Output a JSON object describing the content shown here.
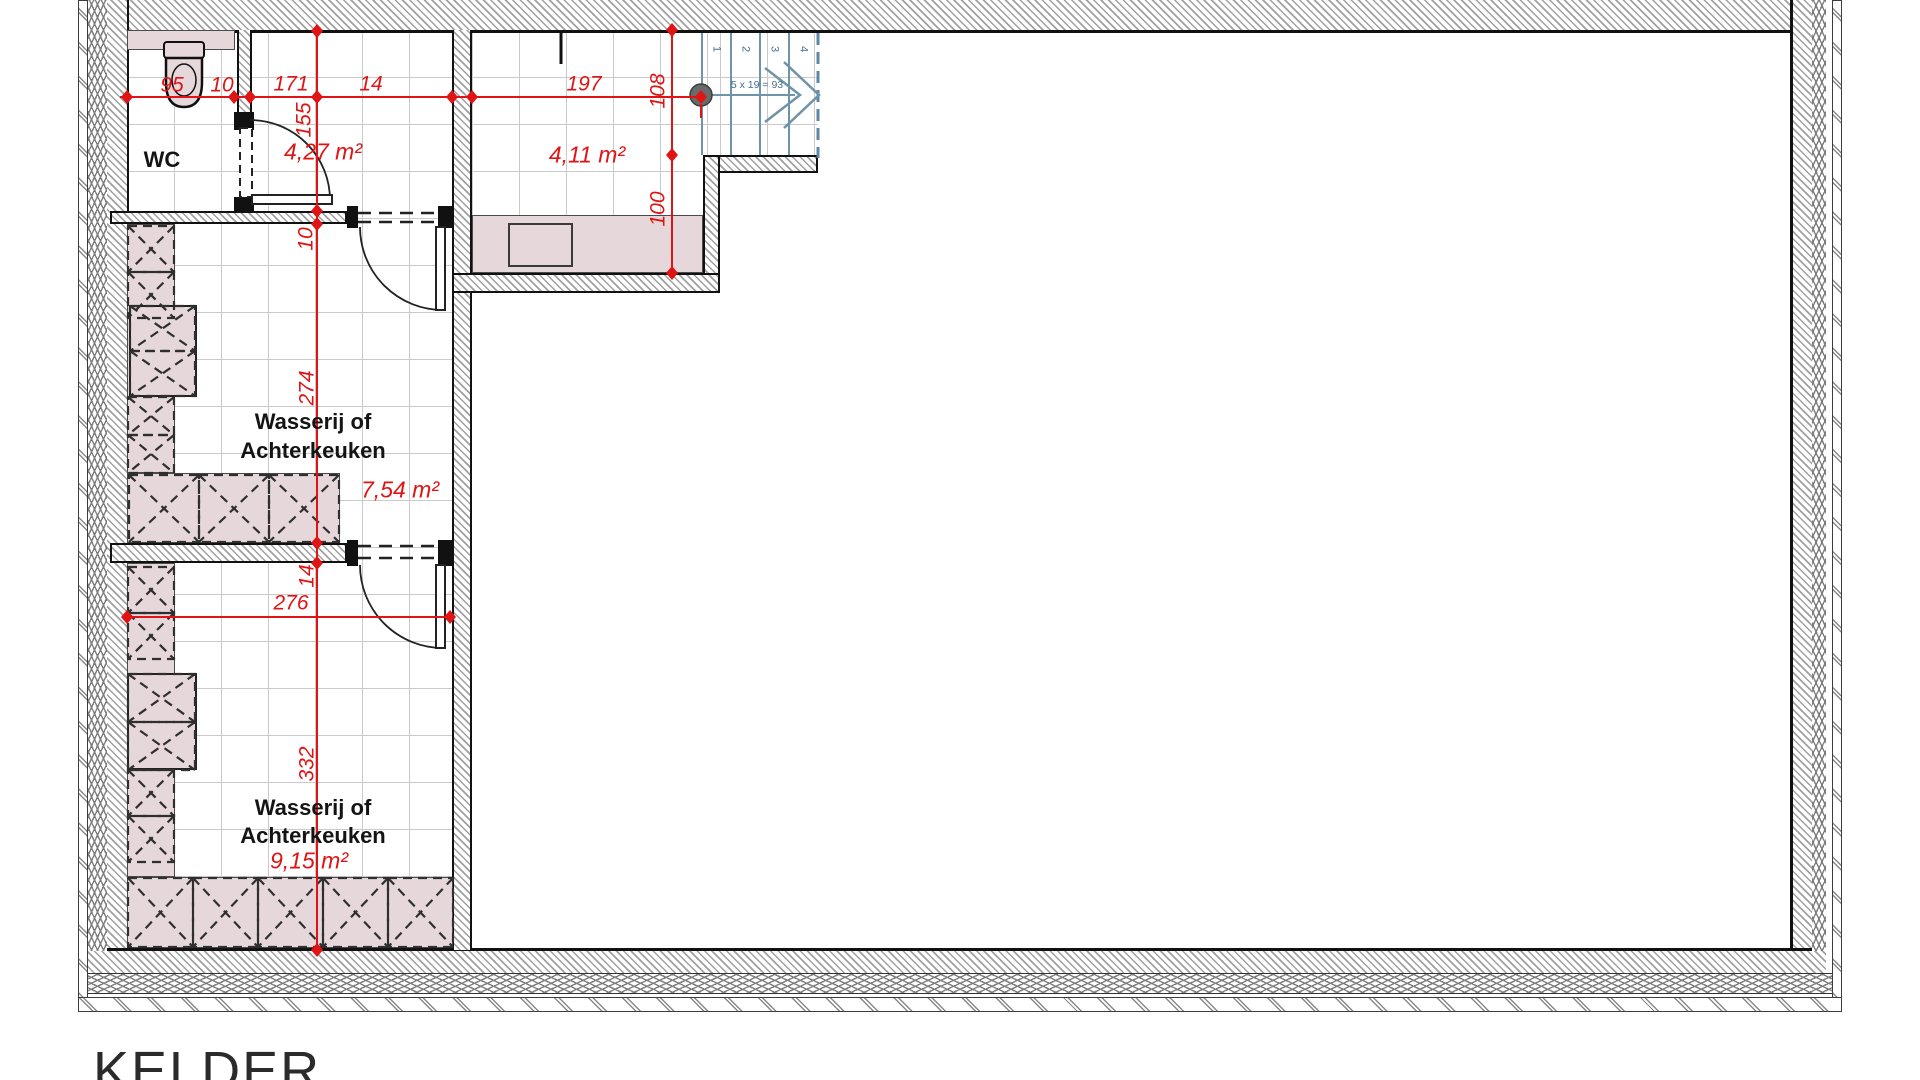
{
  "title": "KELDER",
  "rooms": {
    "wc": {
      "label": "WC"
    },
    "hall": {
      "area": "4,27 m²"
    },
    "stair_landing": {
      "area": "4,11 m²"
    },
    "laundry_upper": {
      "line1": "Wasserij of",
      "line2": "Achterkeuken",
      "area": "7,54 m²"
    },
    "laundry_lower": {
      "line1": "Wasserij of",
      "line2": "Achterkeuken",
      "area": "9,15 m²"
    }
  },
  "dimensions": {
    "wc_width": "95",
    "wc_wall_thickness": "10",
    "hall_width": "171",
    "wall_b_thickness": "14",
    "landing_width": "197",
    "hall_depth": "155",
    "wall_c_thickness": "10",
    "laundry_upper_depth": "274",
    "wall_d_thickness": "14",
    "laundry_lower_depth": "332",
    "stair_upper_run": "108",
    "stair_lower_run": "100",
    "laundry_lower_width": "276"
  },
  "stairs": {
    "formula": "5 x 19 = 93",
    "steps": [
      "1",
      "2",
      "3",
      "4"
    ]
  },
  "colors": {
    "dimension_red": "#e01414",
    "stair_blue": "#6f93a8",
    "stair_dark_blue": "#5d87a5",
    "counter_pink": "#e6d7db",
    "wall_hatch_gray": "#a0a0a0",
    "tile_grid_gray": "#cacaca",
    "outline_black": "#111111"
  }
}
